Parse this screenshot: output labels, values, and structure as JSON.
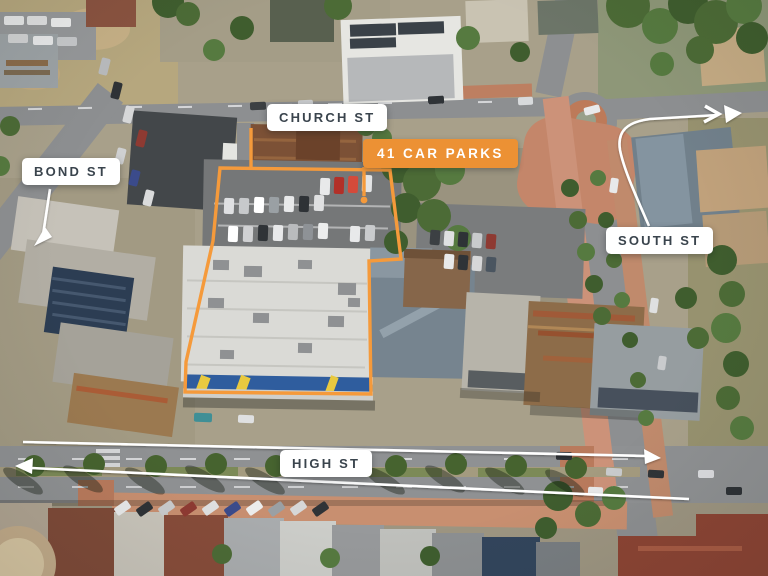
{
  "annotations": {
    "streets": [
      {
        "id": "church-st",
        "label": "CHURCH ST"
      },
      {
        "id": "bond-st",
        "label": "BOND ST"
      },
      {
        "id": "south-st",
        "label": "SOUTH ST"
      },
      {
        "id": "high-st",
        "label": "HIGH ST"
      }
    ],
    "badge": {
      "label": "41 CAR PARKS"
    }
  },
  "icons": [
    "arrow-left-icon",
    "arrow-right-icon",
    "arrow-down-left-icon",
    "chevron-right-icon",
    "leader-dot-icon"
  ],
  "colors": {
    "accent_orange": "#EC9134",
    "boundary_orange": "#F59A3B",
    "label_background": "#FFFFFF",
    "label_text": "#3A444D",
    "badge_text": "#FFFFFF",
    "annotation_white": "#FFFFFF"
  }
}
